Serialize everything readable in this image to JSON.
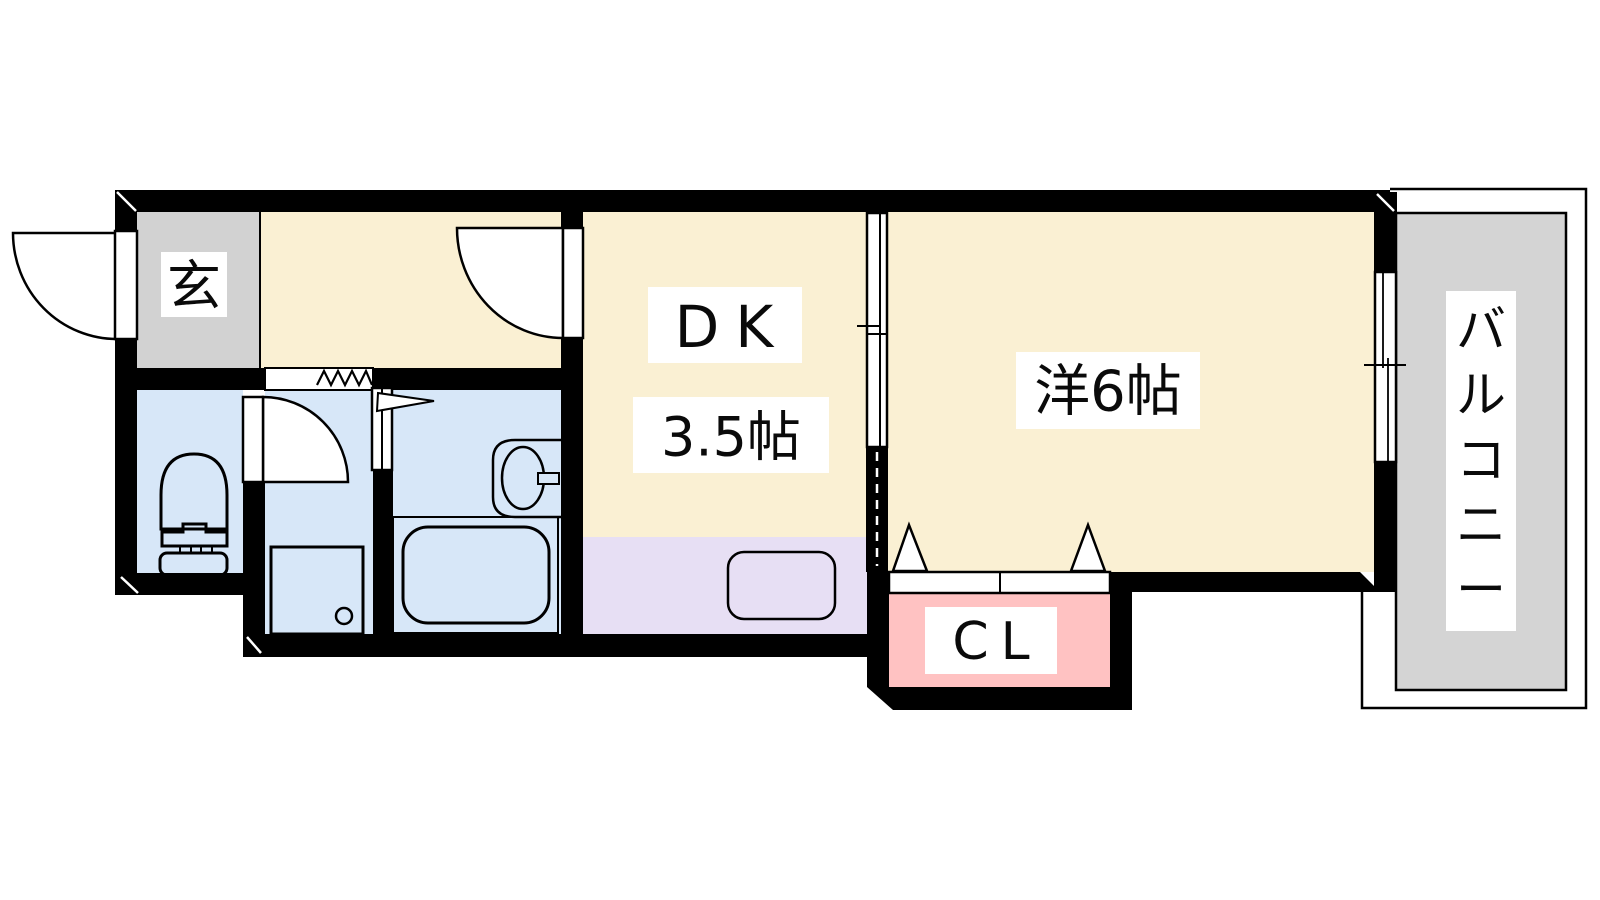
{
  "floorplan": {
    "labels": {
      "entry": "玄",
      "dk": "DK",
      "dk_size": "3.5帖",
      "western_room": "洋6帖",
      "closet": "CL",
      "balcony": "バルコニー"
    },
    "colors": {
      "wall": "#000000",
      "room_cream": "#FAF0D3",
      "wet_area_blue": "#D7E7F8",
      "kitchen_lavender": "#E7DFF4",
      "closet_pink": "#FFC2C2",
      "entry_gray": "#D2D2D2",
      "balcony_gray": "#D4D4D4",
      "label_bg": "#FFFFFF"
    }
  }
}
